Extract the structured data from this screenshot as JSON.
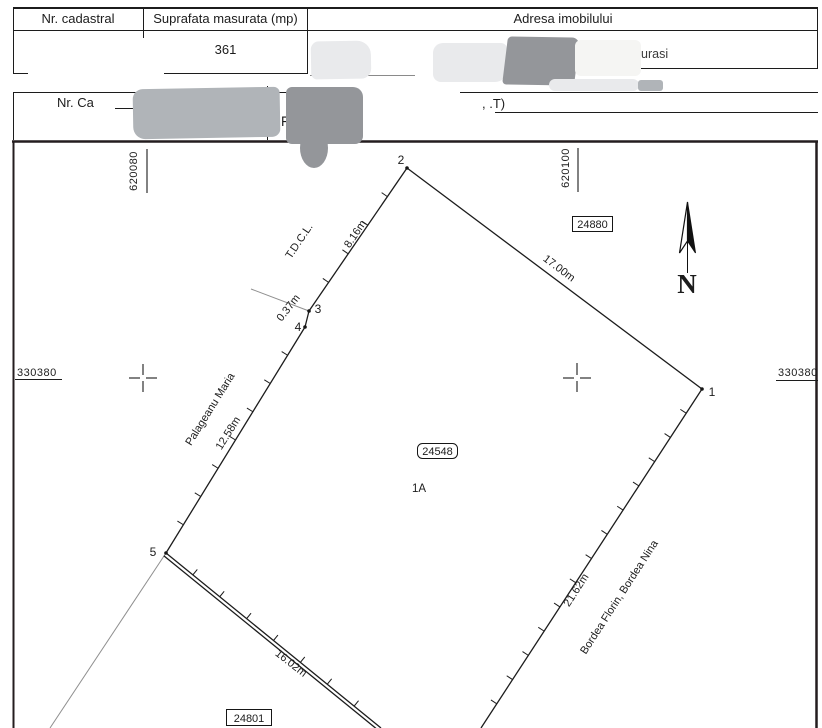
{
  "document": {
    "table1": {
      "col1_header": "Nr. cadastral",
      "col2_header": "Suprafata masurata (mp)",
      "col3_header": "Adresa imobilului",
      "suprafata_value": "361",
      "adresa_fragment": "urasi"
    },
    "table2": {
      "row1_left_fragment": "Nr. Ca",
      "row1_right_fragment": ",  .T)",
      "row2_fragment": "F"
    }
  },
  "map": {
    "grid": {
      "easting_left": "620080",
      "easting_right": "620100",
      "northing_left": "330380",
      "northing_right": "330380"
    },
    "north_arrow_label": "N",
    "parcel_number": "24548",
    "lot_label": "1A",
    "neighbor_parcel_north": "24880",
    "neighbor_parcel_south": "24801",
    "owner_west": "Palageanu Maria",
    "owner_east": "Bordea Florin, Bordea Nina",
    "abutter_north": "T.D.C.L.",
    "points": {
      "p1": "1",
      "p2": "2",
      "p3": "3",
      "p4": "4",
      "p5": "5"
    },
    "measurements": {
      "seg_2_3": "8.16m",
      "seg_3_4": "0.37m",
      "seg_4_5": "12.58m",
      "seg_2_1": "17.00m",
      "seg_1_s": "21.62m",
      "seg_5_s": "16.02m"
    }
  },
  "colors": {
    "line": "#1c1c1c",
    "redaction_dark": "#94969a",
    "redaction_medium": "#b0b4b8",
    "redaction_light": "#e9eaec",
    "redaction_xlight": "#f5f5f3"
  }
}
